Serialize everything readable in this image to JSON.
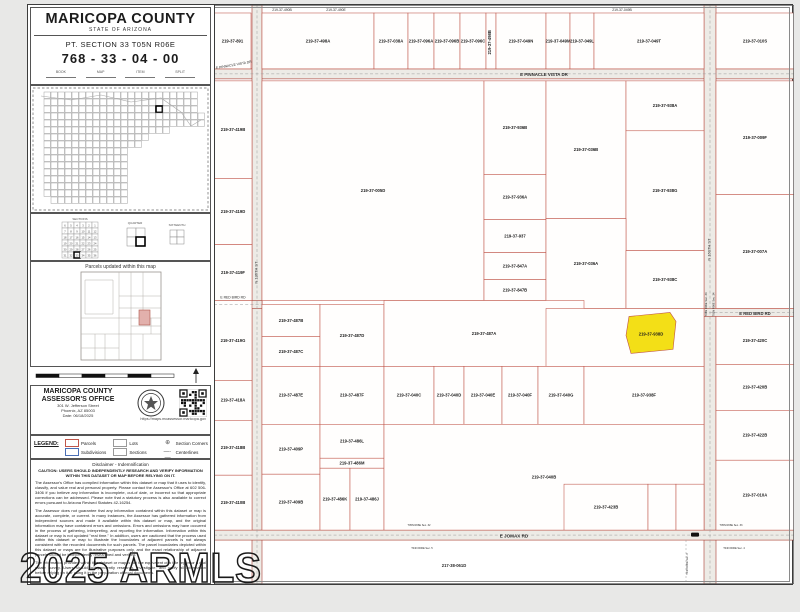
{
  "watermark": "2025 ARMLS",
  "sidebar": {
    "title": "MARICOPA COUNTY",
    "subtitle": "STATE OF ARIZONA",
    "section_text": "PT. SECTION 33 T05N R06E",
    "parcel_number": "768 - 33 - 04 - 00",
    "header_cols": [
      "BOOK",
      "MAP",
      "ITEM",
      "SPLIT"
    ],
    "diagram_titles": [
      "SECTIONS",
      "QUARTER",
      "SIXTEENTH"
    ],
    "updated_label": "Parcels updated within this map",
    "office": {
      "name_line1": "MARICOPA COUNTY",
      "name_line2": "ASSESSOR'S OFFICE",
      "address1": "301 W. Jefferson Street",
      "address2": "Phoenix, AZ 85003",
      "date": "Date: 06/18/2025",
      "url": "https://maps.mcassessor.maricopa.gov"
    },
    "legend": {
      "label": "LEGEND:",
      "items": [
        {
          "name": "Parcels",
          "swatch": "parcel"
        },
        {
          "name": "Lots",
          "swatch": "lots"
        },
        {
          "name": "Section Corners",
          "swatch": "corner"
        },
        {
          "name": "Subdivisions",
          "swatch": "subdivision"
        },
        {
          "name": "Sections",
          "swatch": "sections"
        },
        {
          "name": "Centerlines",
          "swatch": "centerline"
        }
      ]
    },
    "disclaimer": {
      "title": "Disclaimer - Indemnification",
      "caution": "CAUTION: USERS SHOULD INDEPENDENTLY RESEARCH AND VERIFY INFORMATION WITHIN THIS DATASET OR MAP BEFORE RELYING ON IT.",
      "paragraphs": [
        "The Assessor's Office has compiled information within this dataset or map that it uses to identify, classify, and value real and personal property. Please contact the Assessor's Office at 602 506-3406 if you believe any information is incomplete, out-of date, or incorrect so that appropriate corrections can be addressed. Please note that a statutory process is also available to correct errors pursuant to Arizona Revised Statutes 42-16254.",
        "The Assessor does not guarantee that any information contained within this dataset or map is accurate, complete, or current. In many instances, the Assessor has gathered information from independent sources and made it available within this dataset or map, and the original information may have contained errors and omissions. Errors and omissions may have occurred in the process of gathering, interpreting, and reporting the information. Information within this dataset or map is not updated \"real time.\" In addition, users are cautioned that the process used within this dataset or map to illustrate the boundaries of adjacent parcels is not always consistent with the recorded documents for such parcels. The parcel boundaries depicted within this dataset or maps are for illustrative purposes only, and the exact relationship of adjacent parcels should be independently researched and verified.",
        "The information provided within this dataset or map is not the equivalent of a title report or a real estate survey. Users should independently research, investigate, and verify all information before relying on it or using it in the preparation of legal documents."
      ]
    }
  },
  "map": {
    "colors": {
      "parcel_line": "#bf5347",
      "road_line": "#a93c31",
      "road_fill": "#edebe6",
      "label": "#1c1c1c",
      "highlight": "#f3df17"
    },
    "roads": [
      {
        "x": 0,
        "y": 64,
        "w": 580,
        "h": 10
      },
      {
        "x": 38,
        "y": 0,
        "w": 10,
        "h": 580
      },
      {
        "x": 490,
        "y": 0,
        "w": 12,
        "h": 580
      },
      {
        "x": 0,
        "y": 296,
        "w": 48,
        "h": 8
      },
      {
        "x": 490,
        "y": 304,
        "w": 90,
        "h": 8
      },
      {
        "x": 0,
        "y": 526,
        "w": 580,
        "h": 10
      }
    ],
    "parcels": [
      {
        "x": 0,
        "y": 8,
        "w": 37,
        "h": 56,
        "id": "219-37-891"
      },
      {
        "x": 48,
        "y": 8,
        "w": 112,
        "h": 56,
        "id": "219-37-498A"
      },
      {
        "x": 160,
        "y": 8,
        "w": 34,
        "h": 56,
        "id": "219-37-038A"
      },
      {
        "x": 194,
        "y": 8,
        "w": 26,
        "h": 56,
        "id": "219-37-096A"
      },
      {
        "x": 220,
        "y": 8,
        "w": 26,
        "h": 56,
        "id": "219-37-096B"
      },
      {
        "x": 246,
        "y": 8,
        "w": 26,
        "h": 56,
        "id": "219-37-096C"
      },
      {
        "x": 272,
        "y": 8,
        "w": 10,
        "h": 56,
        "id": "219-37-498B",
        "vert": true
      },
      {
        "x": 282,
        "y": 8,
        "w": 50,
        "h": 56,
        "id": "219-37-049N"
      },
      {
        "x": 332,
        "y": 8,
        "w": 24,
        "h": 56,
        "id": "219-37-049M"
      },
      {
        "x": 356,
        "y": 8,
        "w": 24,
        "h": 56,
        "id": "219-37-049L"
      },
      {
        "x": 380,
        "y": 8,
        "w": 110,
        "h": 56,
        "id": "219-37-049T"
      },
      {
        "x": 502,
        "y": 8,
        "w": 78,
        "h": 56,
        "id": "219-37-010S"
      },
      {
        "x": 0,
        "y": 76,
        "w": 38,
        "h": 98,
        "id": "219-37-419B"
      },
      {
        "x": 0,
        "y": 174,
        "w": 38,
        "h": 66,
        "id": "219-37-419D"
      },
      {
        "x": 0,
        "y": 240,
        "w": 38,
        "h": 56,
        "id": "219-37-419F"
      },
      {
        "x": 48,
        "y": 76,
        "w": 222,
        "h": 220,
        "id": "219-37-005D"
      },
      {
        "x": 270,
        "y": 76,
        "w": 62,
        "h": 94,
        "id": "219-37-936B"
      },
      {
        "x": 270,
        "y": 170,
        "w": 62,
        "h": 45,
        "id": "219-37-936A"
      },
      {
        "x": 270,
        "y": 215,
        "w": 62,
        "h": 33,
        "id": "219-37-937"
      },
      {
        "x": 270,
        "y": 248,
        "w": 62,
        "h": 27,
        "id": "219-37-847A"
      },
      {
        "x": 270,
        "y": 275,
        "w": 62,
        "h": 21,
        "id": "219-37-847B"
      },
      {
        "x": 332,
        "y": 76,
        "w": 80,
        "h": 138,
        "id": "219-37-036B"
      },
      {
        "x": 412,
        "y": 76,
        "w": 78,
        "h": 50,
        "id": "219-37-938A"
      },
      {
        "x": 412,
        "y": 126,
        "w": 78,
        "h": 120,
        "id": "219-37-938G"
      },
      {
        "x": 332,
        "y": 214,
        "w": 80,
        "h": 90,
        "id": "219-37-036A"
      },
      {
        "x": 412,
        "y": 246,
        "w": 78,
        "h": 58,
        "id": "219-37-938C"
      },
      {
        "x": 502,
        "y": 76,
        "w": 78,
        "h": 114,
        "id": "219-37-009F"
      },
      {
        "x": 502,
        "y": 190,
        "w": 78,
        "h": 114,
        "id": "219-37-007A"
      },
      {
        "x": 0,
        "y": 296,
        "w": 38,
        "h": 80,
        "id": "219-37-419G"
      },
      {
        "x": 0,
        "y": 376,
        "w": 38,
        "h": 40,
        "id": "219-37-418A"
      },
      {
        "x": 0,
        "y": 416,
        "w": 38,
        "h": 55,
        "id": "219-37-418B"
      },
      {
        "x": 0,
        "y": 471,
        "w": 38,
        "h": 55,
        "id": "219-37-410B"
      },
      {
        "x": 48,
        "y": 300,
        "w": 58,
        "h": 32,
        "id": "219-37-487B"
      },
      {
        "x": 48,
        "y": 332,
        "w": 58,
        "h": 30,
        "id": "219-37-487C"
      },
      {
        "x": 106,
        "y": 300,
        "w": 64,
        "h": 62,
        "id": "219-37-487D"
      },
      {
        "x": 48,
        "y": 362,
        "w": 58,
        "h": 58,
        "id": "219-37-487E"
      },
      {
        "x": 106,
        "y": 362,
        "w": 64,
        "h": 58,
        "id": "219-37-487F"
      },
      {
        "x": 170,
        "y": 296,
        "w": 200,
        "h": 66,
        "id": "219-37-487A"
      },
      {
        "x": 332,
        "y": 304,
        "w": 158,
        "h": 58,
        "id": ""
      },
      {
        "x": 48,
        "y": 420,
        "w": 58,
        "h": 50,
        "id": "219-37-409P"
      },
      {
        "x": 48,
        "y": 470,
        "w": 58,
        "h": 56,
        "id": "219-37-409B"
      },
      {
        "x": 106,
        "y": 420,
        "w": 64,
        "h": 34,
        "id": "219-37-486L"
      },
      {
        "x": 106,
        "y": 454,
        "w": 64,
        "h": 10,
        "id": "219-37-486M"
      },
      {
        "x": 106,
        "y": 464,
        "w": 30,
        "h": 62,
        "id": "219-37-486K"
      },
      {
        "x": 136,
        "y": 464,
        "w": 34,
        "h": 62,
        "id": "219-37-486J"
      },
      {
        "x": 170,
        "y": 362,
        "w": 50,
        "h": 58,
        "id": "219-37-040C"
      },
      {
        "x": 220,
        "y": 362,
        "w": 30,
        "h": 58,
        "id": "219-37-040D"
      },
      {
        "x": 250,
        "y": 362,
        "w": 38,
        "h": 58,
        "id": "219-37-040E"
      },
      {
        "x": 288,
        "y": 362,
        "w": 36,
        "h": 58,
        "id": "219-37-040F"
      },
      {
        "x": 324,
        "y": 362,
        "w": 46,
        "h": 58,
        "id": "219-37-040G"
      },
      {
        "x": 370,
        "y": 362,
        "w": 120,
        "h": 58,
        "id": "219-37-938F"
      },
      {
        "x": 170,
        "y": 420,
        "w": 320,
        "h": 106,
        "id": "219-37-040B"
      },
      {
        "x": 350,
        "y": 480,
        "w": 84,
        "h": 46,
        "id": "219-37-423B"
      },
      {
        "x": 434,
        "y": 480,
        "w": 28,
        "h": 46,
        "id": ""
      },
      {
        "x": 462,
        "y": 480,
        "w": 28,
        "h": 46,
        "id": ""
      },
      {
        "x": 502,
        "y": 312,
        "w": 78,
        "h": 48,
        "id": "219-37-420C"
      },
      {
        "x": 502,
        "y": 360,
        "w": 78,
        "h": 46,
        "id": "219-37-420B"
      },
      {
        "x": 502,
        "y": 406,
        "w": 78,
        "h": 50,
        "id": "219-37-422B"
      },
      {
        "x": 502,
        "y": 456,
        "w": 78,
        "h": 70,
        "id": "219-37-010A"
      }
    ],
    "highlight": {
      "id": "219-37-938D",
      "points": "415,312 456,308 462,317 459,345 417,349 412,331",
      "label_x": 437,
      "label_y": 330
    },
    "labels": [
      {
        "x": 68,
        "y": 6,
        "t": "219-37-490B",
        "s": 3.4
      },
      {
        "x": 122,
        "y": 6,
        "t": "219-37-490E",
        "s": 3.4
      },
      {
        "x": 408,
        "y": 6,
        "t": "219-37-049B",
        "s": 3.4
      },
      {
        "x": 330,
        "y": 71,
        "t": "E PINNACLE VISTA DR",
        "s": 4.4
      },
      {
        "x": 20,
        "y": 61,
        "t": "E PINNACLE VISTA DR",
        "s": 3.4,
        "r": -10
      },
      {
        "x": 19,
        "y": 294,
        "t": "E RED BIRD RD",
        "s": 3.4
      },
      {
        "x": 541,
        "y": 310.5,
        "t": "E RED BIRD RD",
        "s": 4.2
      },
      {
        "x": 300,
        "y": 533.5,
        "t": "E JOMAX RD",
        "s": 4.6
      },
      {
        "x": 43.5,
        "y": 268,
        "t": "N 136TH ST",
        "s": 4,
        "r": -90
      },
      {
        "x": 496.5,
        "y": 245,
        "t": "N 160TH ST",
        "s": 4,
        "r": -90
      },
      {
        "x": 493,
        "y": 300,
        "t": "T05N R06E Sec. 33",
        "s": 2.7,
        "r": -90
      },
      {
        "x": 500.5,
        "y": 300,
        "t": "T05N R06E Sec. 34",
        "s": 2.7,
        "r": -90
      },
      {
        "x": 240,
        "y": 563,
        "t": "217-38-061D",
        "s": 4.2
      },
      {
        "x": 205,
        "y": 522,
        "t": "T05N R06E Sec. 32",
        "s": 2.6
      },
      {
        "x": 208,
        "y": 545,
        "t": "T04N R06E Sec. 5",
        "s": 2.6
      },
      {
        "x": 517,
        "y": 522,
        "t": "T05N R06E Sec. 33",
        "s": 2.6
      },
      {
        "x": 520,
        "y": 545,
        "t": "T04N R06E Sec. 4",
        "s": 2.6
      },
      {
        "x": 474,
        "y": 560,
        "t": "T04N R06E Sec. 3",
        "s": 2.6,
        "r": -90
      }
    ]
  }
}
